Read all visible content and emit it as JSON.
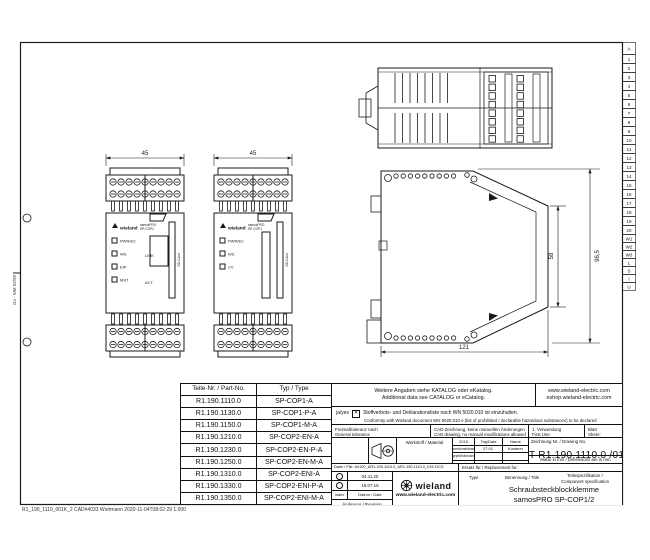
{
  "frame": {
    "edge_text": "Gu - MM 03/98",
    "footer_text": "R1_190_1110_001K_2  CAD#4033  Wortmann  2020-11-04T08:02:29  1.000",
    "right_strip": [
      "A",
      "1",
      "2",
      "3",
      "4",
      "5",
      "6",
      "7",
      "8",
      "9",
      "10",
      "11",
      "12",
      "13",
      "14",
      "15",
      "16",
      "17",
      "18",
      "19",
      "20",
      "W1",
      "W2",
      "W3",
      "L",
      "S",
      "I",
      "U"
    ]
  },
  "dimensions": {
    "front_width": "45",
    "front_height": "58",
    "total_height": "96,5",
    "depth": "121"
  },
  "devices": [
    {
      "brand": "wieland",
      "series": "samosPRO",
      "model": "SP-COP2",
      "leds": [
        "PWR/EC",
        "WS",
        "EIP",
        "MST"
      ],
      "ports": [
        "LINK",
        "ACT"
      ],
      "slot": "SD-Card"
    },
    {
      "brand": "wieland",
      "series": "samosPRO",
      "model": "SP-COP1",
      "leds": [
        "PWR/EC",
        "WS",
        "CV"
      ],
      "ports": [],
      "slot": "SD-Card"
    }
  ],
  "parts_table": {
    "headers": [
      "Teile-Nr. / Part-No.",
      "Typ / Type"
    ],
    "rows": [
      [
        "R1.190.1110.0",
        "SP-COP1-A"
      ],
      [
        "R1.190.1130.0",
        "SP-COP1-P-A"
      ],
      [
        "R1.190.1150.0",
        "SP-COP1-M-A"
      ],
      [
        "R1.190.1210.0",
        "SP-COP2-EN-A"
      ],
      [
        "R1.190.1230.0",
        "SP-COP2-EN-P-A"
      ],
      [
        "R1.190.1250.0",
        "SP-COP2-EN-M-A"
      ],
      [
        "R1.190.1310.0",
        "SP-COP2-ENI-A"
      ],
      [
        "R1.190.1330.0",
        "SP-COP2-ENI-P-A"
      ],
      [
        "R1.190.1350.0",
        "SP-COP2-ENI-M-A"
      ]
    ]
  },
  "title_block": {
    "catalog_de": "Weitere Angaben siehe KATALOG oder eKatalog.",
    "catalog_en": "Additional data see CATALOG or eCatalog.",
    "web1": "www.wieland-electric.com",
    "web2": "eshop.wieland-electric.com",
    "conformity_yes": "ja/yes",
    "conformity_de": "Stoffverbots- und Deklarationsliste nach WN 5020.010 ist einzuhalten.",
    "conformity_en": "Conformity with Wieland document WN 5020.010 e  (list of prohibited / declarable hazardous substances) to be declared",
    "tolerance_de": "Freimaßtoleranz nach",
    "tolerance_en": "General tolerance",
    "cad_de": "CAD-Zeichnung, keine manuellen Änderungen",
    "cad_en": "CAD drawing, no manual modifications allowed",
    "first_use_de": "1. Verwendung",
    "first_use_en": "First Use:",
    "sheet_de": "Blatt",
    "sheet_en": "Sheet:",
    "material_label": "Werkstoff / Material",
    "approvals": {
      "year": "2015",
      "date_col": "Tag/Date",
      "name_col": "Name",
      "rows": [
        {
          "label": "gezeichnet/drawn",
          "date": "27.01.",
          "name": "Kusterer"
        },
        {
          "label": "geprüft/checked",
          "date": "",
          "name": ""
        },
        {
          "label": "Normgepr./standard",
          "date": "",
          "name": ""
        }
      ]
    },
    "drawing_no_label": "Zeichnung Nr.  /  Drawing No.",
    "drawing_no": "T R1.190.1110.0 /01K",
    "units_note": "Maße in mm / Dimensions are in mm",
    "file_note": "Datei / File: 64100_&R1.190.1110.0_&R1.190.1110.0_01K.DCD",
    "replacement_label": "Ersatz für / Replacement for:",
    "revisions": {
      "rows": [
        {
          "date": "04.11.20"
        },
        {
          "date": "19.07.16"
        }
      ],
      "index_label": "Index",
      "date_label": "Datum / Date",
      "revision_label": "Änderung / Revision"
    },
    "logo": {
      "name": "wieland",
      "web": "www.wieland-electric.com"
    },
    "type_label": "Type",
    "title_label": "Benennung / Title",
    "spec_de": "Teilespezifikation /",
    "spec_en": "Component specification",
    "product_line1": "Schraubsteckblockklemme",
    "product_line2": "samosPRO SP-COP1/2"
  }
}
